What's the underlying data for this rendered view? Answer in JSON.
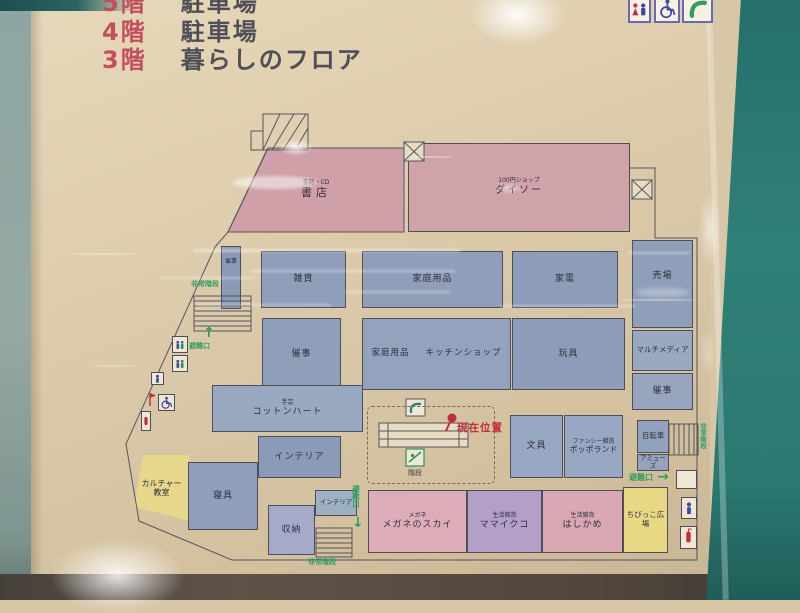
{
  "header": {
    "floors": [
      {
        "num": "5階",
        "label": "駐車場"
      },
      {
        "num": "4階",
        "label": "駐車場"
      },
      {
        "num": "3階",
        "label": "暮らしのフロア"
      }
    ]
  },
  "map": {
    "areas": [
      {
        "id": "bookstore",
        "category": "書籍・CD",
        "name": "書店"
      },
      {
        "id": "daiso",
        "category": "100円ショップ",
        "name": "ダイソー"
      },
      {
        "id": "event-strip",
        "name": "催事"
      },
      {
        "id": "zakka",
        "name": "雑貨"
      },
      {
        "id": "household-1",
        "name": "家庭用品"
      },
      {
        "id": "appliances",
        "name": "家電"
      },
      {
        "id": "sales-floor",
        "name": "売場"
      },
      {
        "id": "multimedia",
        "name": "マルチメディア"
      },
      {
        "id": "event-right",
        "name": "催事"
      },
      {
        "id": "event-2",
        "name": "催事"
      },
      {
        "id": "household-2",
        "name": "家庭用品",
        "name2": "キッチンショップ"
      },
      {
        "id": "toys",
        "name": "玩具"
      },
      {
        "id": "cotton-heart",
        "category": "手芸",
        "name": "コットンハート"
      },
      {
        "id": "interior-1",
        "name": "インテリア"
      },
      {
        "id": "stationery",
        "name": "文具"
      },
      {
        "id": "poppo-land",
        "category": "ファンシー雑貨",
        "name": "ポッポランド"
      },
      {
        "id": "bicycle",
        "name": "自転車"
      },
      {
        "id": "amuse",
        "name": "アミューズ"
      },
      {
        "id": "culture-room",
        "name": "カルチャー教室"
      },
      {
        "id": "bedding",
        "name": "寝具"
      },
      {
        "id": "storage",
        "name": "収納"
      },
      {
        "id": "interior-2",
        "name": "インテリア"
      },
      {
        "id": "megane-no-sky",
        "category": "メガネ",
        "name": "メガネのスカイ"
      },
      {
        "id": "mamaikuko",
        "category": "生活雑貨",
        "name": "ママイクコ"
      },
      {
        "id": "hashikame",
        "category": "生活雑貨",
        "name": "はしかめ"
      },
      {
        "id": "kids-plaza",
        "name": "ちびっこ広場"
      }
    ],
    "signs": {
      "current_location": "現在位置",
      "evacuation_exit": "避難口",
      "emergency_stairs": "非常階段",
      "stairs": "階段"
    },
    "arrows": {
      "up": "↑",
      "down": "↓",
      "right": "→"
    }
  },
  "icons": {
    "restroom": "restroom-icon",
    "wheelchair": "wheelchair-icon",
    "phone": "phone-icon",
    "elevator": "elevator-icon",
    "escalator": "escalator-icon",
    "fire_equipment": "fire-equipment-icon"
  },
  "colors": {
    "sign_green": "#2f9e5f",
    "marker_red": "#bf2f3a",
    "floor_number_red": "#c44e5e",
    "pink_area": "#d0a3ab",
    "blue_area": "#8f9eb9",
    "yellow_area": "#e8d884",
    "purple_area": "#b49fc8",
    "frame_teal": "#2f8078"
  }
}
